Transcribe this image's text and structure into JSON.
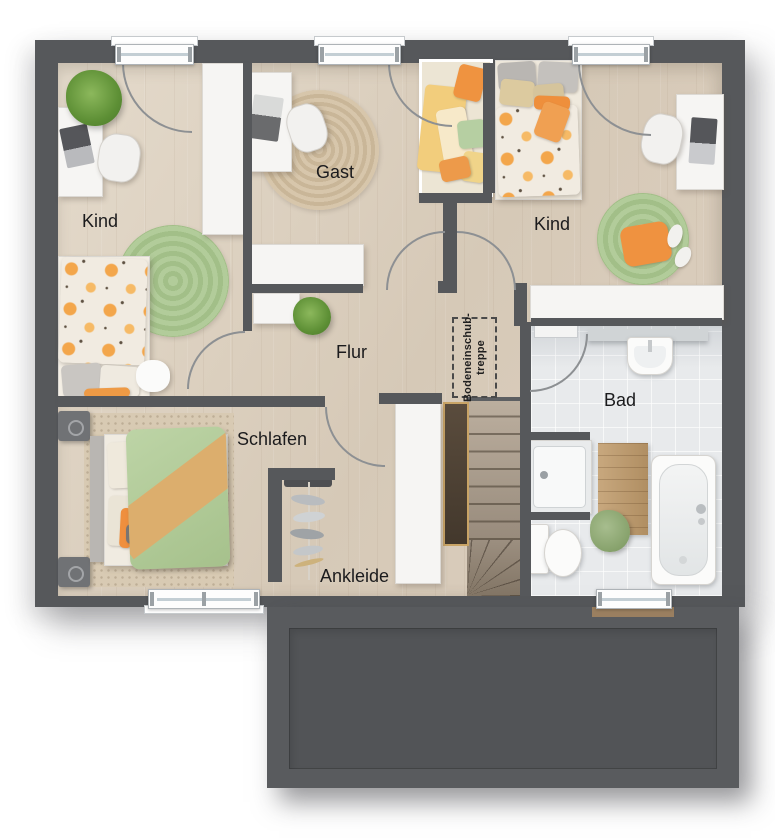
{
  "floor_plan": {
    "rooms": {
      "kind_left": {
        "label": "Kind"
      },
      "gast": {
        "label": "Gast"
      },
      "kind_right": {
        "label": "Kind"
      },
      "flur": {
        "label": "Flur"
      },
      "schlafen": {
        "label": "Schlafen"
      },
      "ankleide": {
        "label": "Ankleide"
      },
      "bad": {
        "label": "Bad"
      }
    },
    "annotations": {
      "attic_stairs": {
        "line1": "Bodeneinschub-",
        "line2": "treppe"
      }
    },
    "colors": {
      "wall": "#56585b",
      "wood_floor": "#d9cdbc",
      "tile_floor": "#e8eaec",
      "accent_orange": "#f0923f",
      "accent_green": "#adc795",
      "accent_yellow": "#f2cd7c",
      "stair_wood": "#a89b8c",
      "attic_ladder_trim": "#c9a466",
      "garage_roof": "#55575a"
    }
  }
}
